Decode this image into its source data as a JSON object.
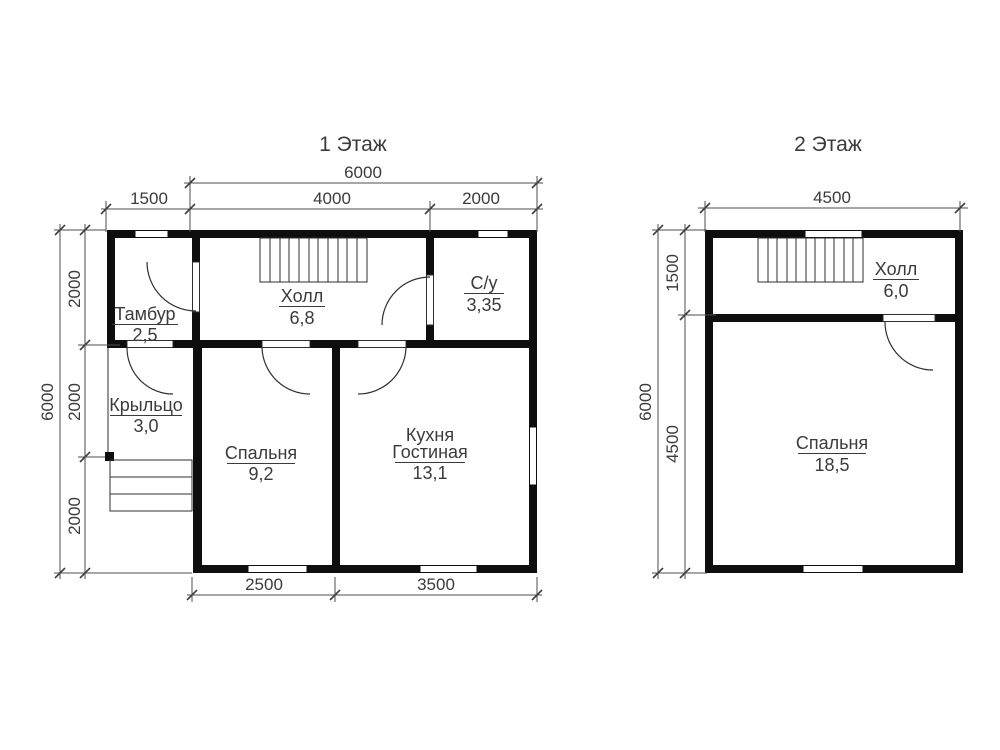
{
  "colors": {
    "wall": "#0e0e0e",
    "dimension_line": "#4d4d4d",
    "text": "#3b3b3b",
    "background": "#ffffff"
  },
  "floor1": {
    "title": "1 Этаж",
    "dimensions": {
      "top_total": "6000",
      "top_segments": [
        "1500",
        "4000",
        "2000"
      ],
      "left_total": "6000",
      "left_segments": [
        "2000",
        "2000",
        "2000"
      ],
      "bottom_segments": [
        "2500",
        "3500"
      ]
    },
    "rooms": {
      "tambur": {
        "name": "Тамбур",
        "area": "2,5"
      },
      "hall": {
        "name": "Холл",
        "area": "6,8"
      },
      "bathroom": {
        "name": "С/у",
        "area": "3,35"
      },
      "porch": {
        "name": "Крыльцо",
        "area": "3,0"
      },
      "bedroom": {
        "name": "Спальня",
        "area": "9,2"
      },
      "kitchen": {
        "name_line1": "Кухня",
        "name_line2": "Гостиная",
        "area": "13,1"
      }
    }
  },
  "floor2": {
    "title": "2 Этаж",
    "dimensions": {
      "top_total": "4500",
      "left_total": "6000",
      "left_segments": [
        "1500",
        "4500"
      ]
    },
    "rooms": {
      "hall": {
        "name": "Холл",
        "area": "6,0"
      },
      "bedroom": {
        "name": "Спальня",
        "area": "18,5"
      }
    }
  }
}
